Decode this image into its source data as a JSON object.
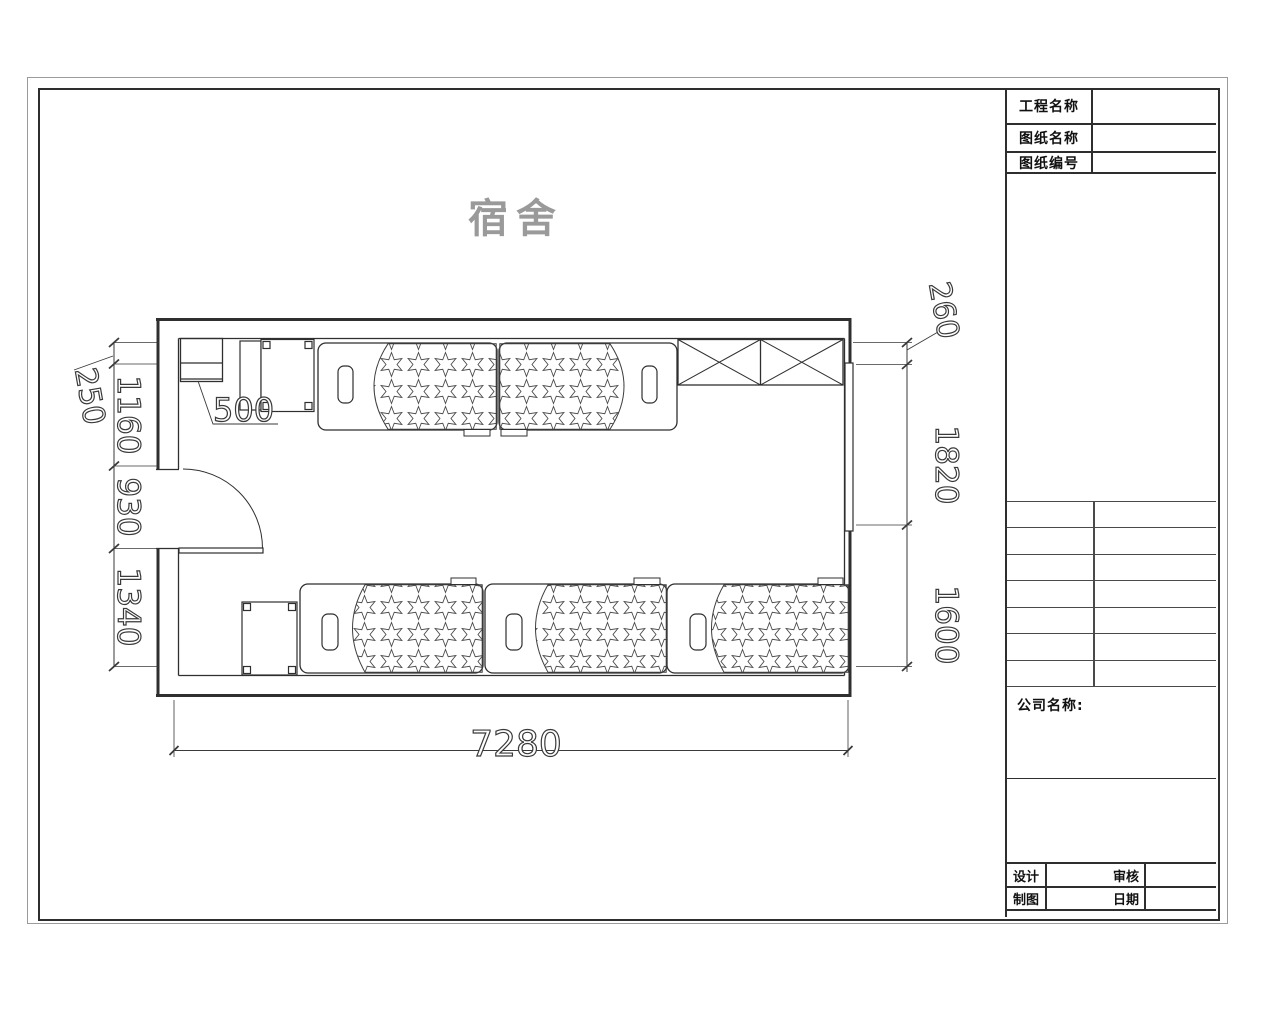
{
  "drawing": {
    "title": "宿舍"
  },
  "title_block": {
    "info_rows": [
      {
        "label": "工程名称",
        "value": ""
      },
      {
        "label": "图纸名称",
        "value": ""
      },
      {
        "label": "图纸编号",
        "value": ""
      }
    ],
    "company": {
      "label": "公司名称:",
      "value": ""
    },
    "sign_rows": [
      {
        "label_a": "设计",
        "value_a": "",
        "label_b": "审核",
        "value_b": ""
      },
      {
        "label_a": "制图",
        "value_a": "",
        "label_b": "日期",
        "value_b": ""
      }
    ]
  },
  "dimensions": {
    "left_top": "250",
    "left": [
      "1160",
      "930",
      "1340"
    ],
    "right_top": "260",
    "right": [
      "1820",
      "1600"
    ],
    "bottom": "7280",
    "leader": "500"
  },
  "colors": {
    "line": "#2f2f2f",
    "frame_outer": "#9b9b9b",
    "title_gray": "#9a9a9a"
  }
}
